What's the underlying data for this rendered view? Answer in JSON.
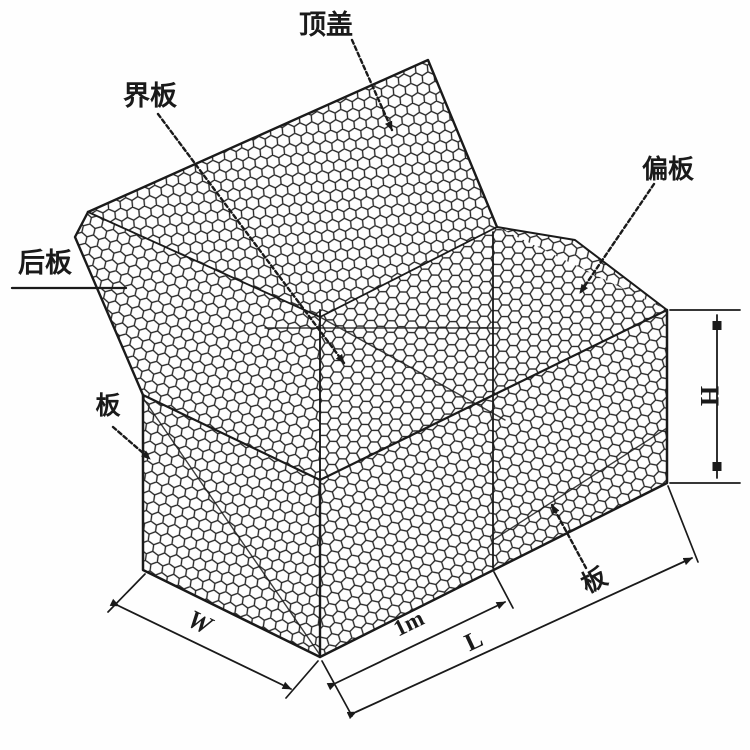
{
  "diagram": {
    "kind": "gabion wire-mesh box structural line drawing",
    "labels": {
      "top_cover": "顶盖",
      "divider_plate": "界板",
      "offset_plate": "偏板",
      "back_plate": "后板",
      "side_plate": "板",
      "front_plate": "板"
    },
    "dimensions": {
      "width": "W",
      "cell_length": "1m",
      "length": "L",
      "height": "H"
    },
    "colors": {
      "ink": "#1a1a1a",
      "background": "#ffffff"
    }
  }
}
